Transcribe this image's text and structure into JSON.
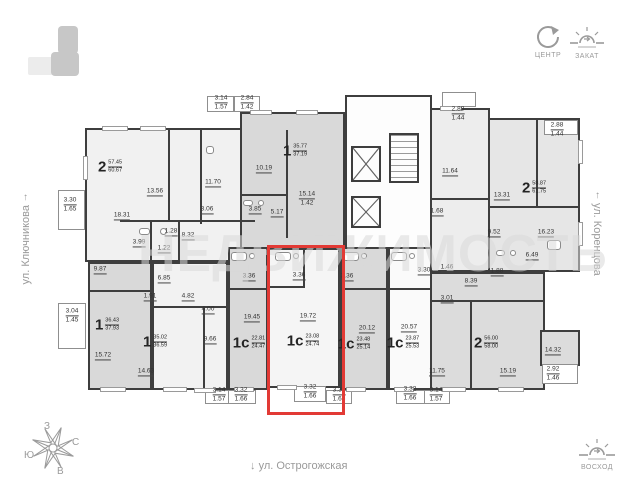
{
  "watermark": "НЕДВИЖИМОСТЬ",
  "streets": {
    "left": "ул. Ключникова",
    "right": "ул. Коренцова",
    "bottom": "ул. Острогожская",
    "arrow_up": "↑",
    "arrow_down": "↓"
  },
  "compass": {
    "center_label": "ЦЕНТР",
    "sunset_label": "ЗАКАТ",
    "sunrise_label": "ВОСХОД",
    "rose": {
      "north": "С",
      "south": "Ю",
      "west": "З",
      "east": "В"
    }
  },
  "icons": {
    "minimap": "building-position-minimap",
    "center": "compass-center-icon",
    "sunset": "sunset-icon",
    "sunrise": "sunrise-icon",
    "rose": "compass-rose-icon"
  },
  "apartments": [
    {
      "type": "2",
      "area1": "57.45",
      "area2": "60.67",
      "highlighted": false
    },
    {
      "type": "1",
      "area1": "35.77",
      "area2": "37.19",
      "highlighted": false
    },
    {
      "type": "2",
      "area1": "58.87",
      "area2": "61.75",
      "highlighted": false
    },
    {
      "type": "1",
      "area1": "36.43",
      "area2": "37.93",
      "highlighted": false
    },
    {
      "type": "1",
      "area1": "35.02",
      "area2": "36.59",
      "highlighted": false
    },
    {
      "type": "1с",
      "area1": "22.81",
      "area2": "24.47",
      "highlighted": false
    },
    {
      "type": "1с",
      "area1": "23.08",
      "area2": "24.74",
      "highlighted": true
    },
    {
      "type": "1с",
      "area1": "23.48",
      "area2": "25.14",
      "highlighted": false
    },
    {
      "type": "1с",
      "area1": "23.87",
      "area2": "25.53",
      "highlighted": false
    },
    {
      "type": "2",
      "area1": "56.00",
      "area2": "58.00",
      "highlighted": false
    }
  ],
  "dimensions": [
    "13.56",
    "18.31",
    "11.70",
    "3.30\n1.65",
    "3.14\n1.57",
    "2.84\n1.42",
    "10.19",
    "15.14\n1.42",
    "5.17",
    "3.85",
    "3.06",
    "1.28",
    "8.32",
    "1.22",
    "3.99",
    "9.87",
    "6.85",
    "1.91",
    "4.82",
    "4.00",
    "9.66",
    "3.04\n1.45",
    "15.72",
    "14.63",
    "19.45",
    "3.36",
    "19.72",
    "3.36",
    "20.12",
    "3.36",
    "20.57",
    "3.30",
    "1.46",
    "3.01",
    "8.39",
    "1.88",
    "11.75",
    "15.19",
    "14.32",
    "2.92\n1.46",
    "6.49",
    "16.23",
    "9.52",
    "13.31",
    "11.64",
    "1.68",
    "2.88\n1.44",
    "2.88\n1.44",
    "3.14\n1.57",
    "3.32\n1.66",
    "3.32\n1.66",
    "3.32\n1.66",
    "3.32\n1.66",
    "3.14\n1.57"
  ],
  "colors": {
    "highlight": "#e23a35",
    "wall": "#3e3e3e",
    "fill_dark": "#d9d9d9",
    "fill_light": "#f2f2f2"
  }
}
